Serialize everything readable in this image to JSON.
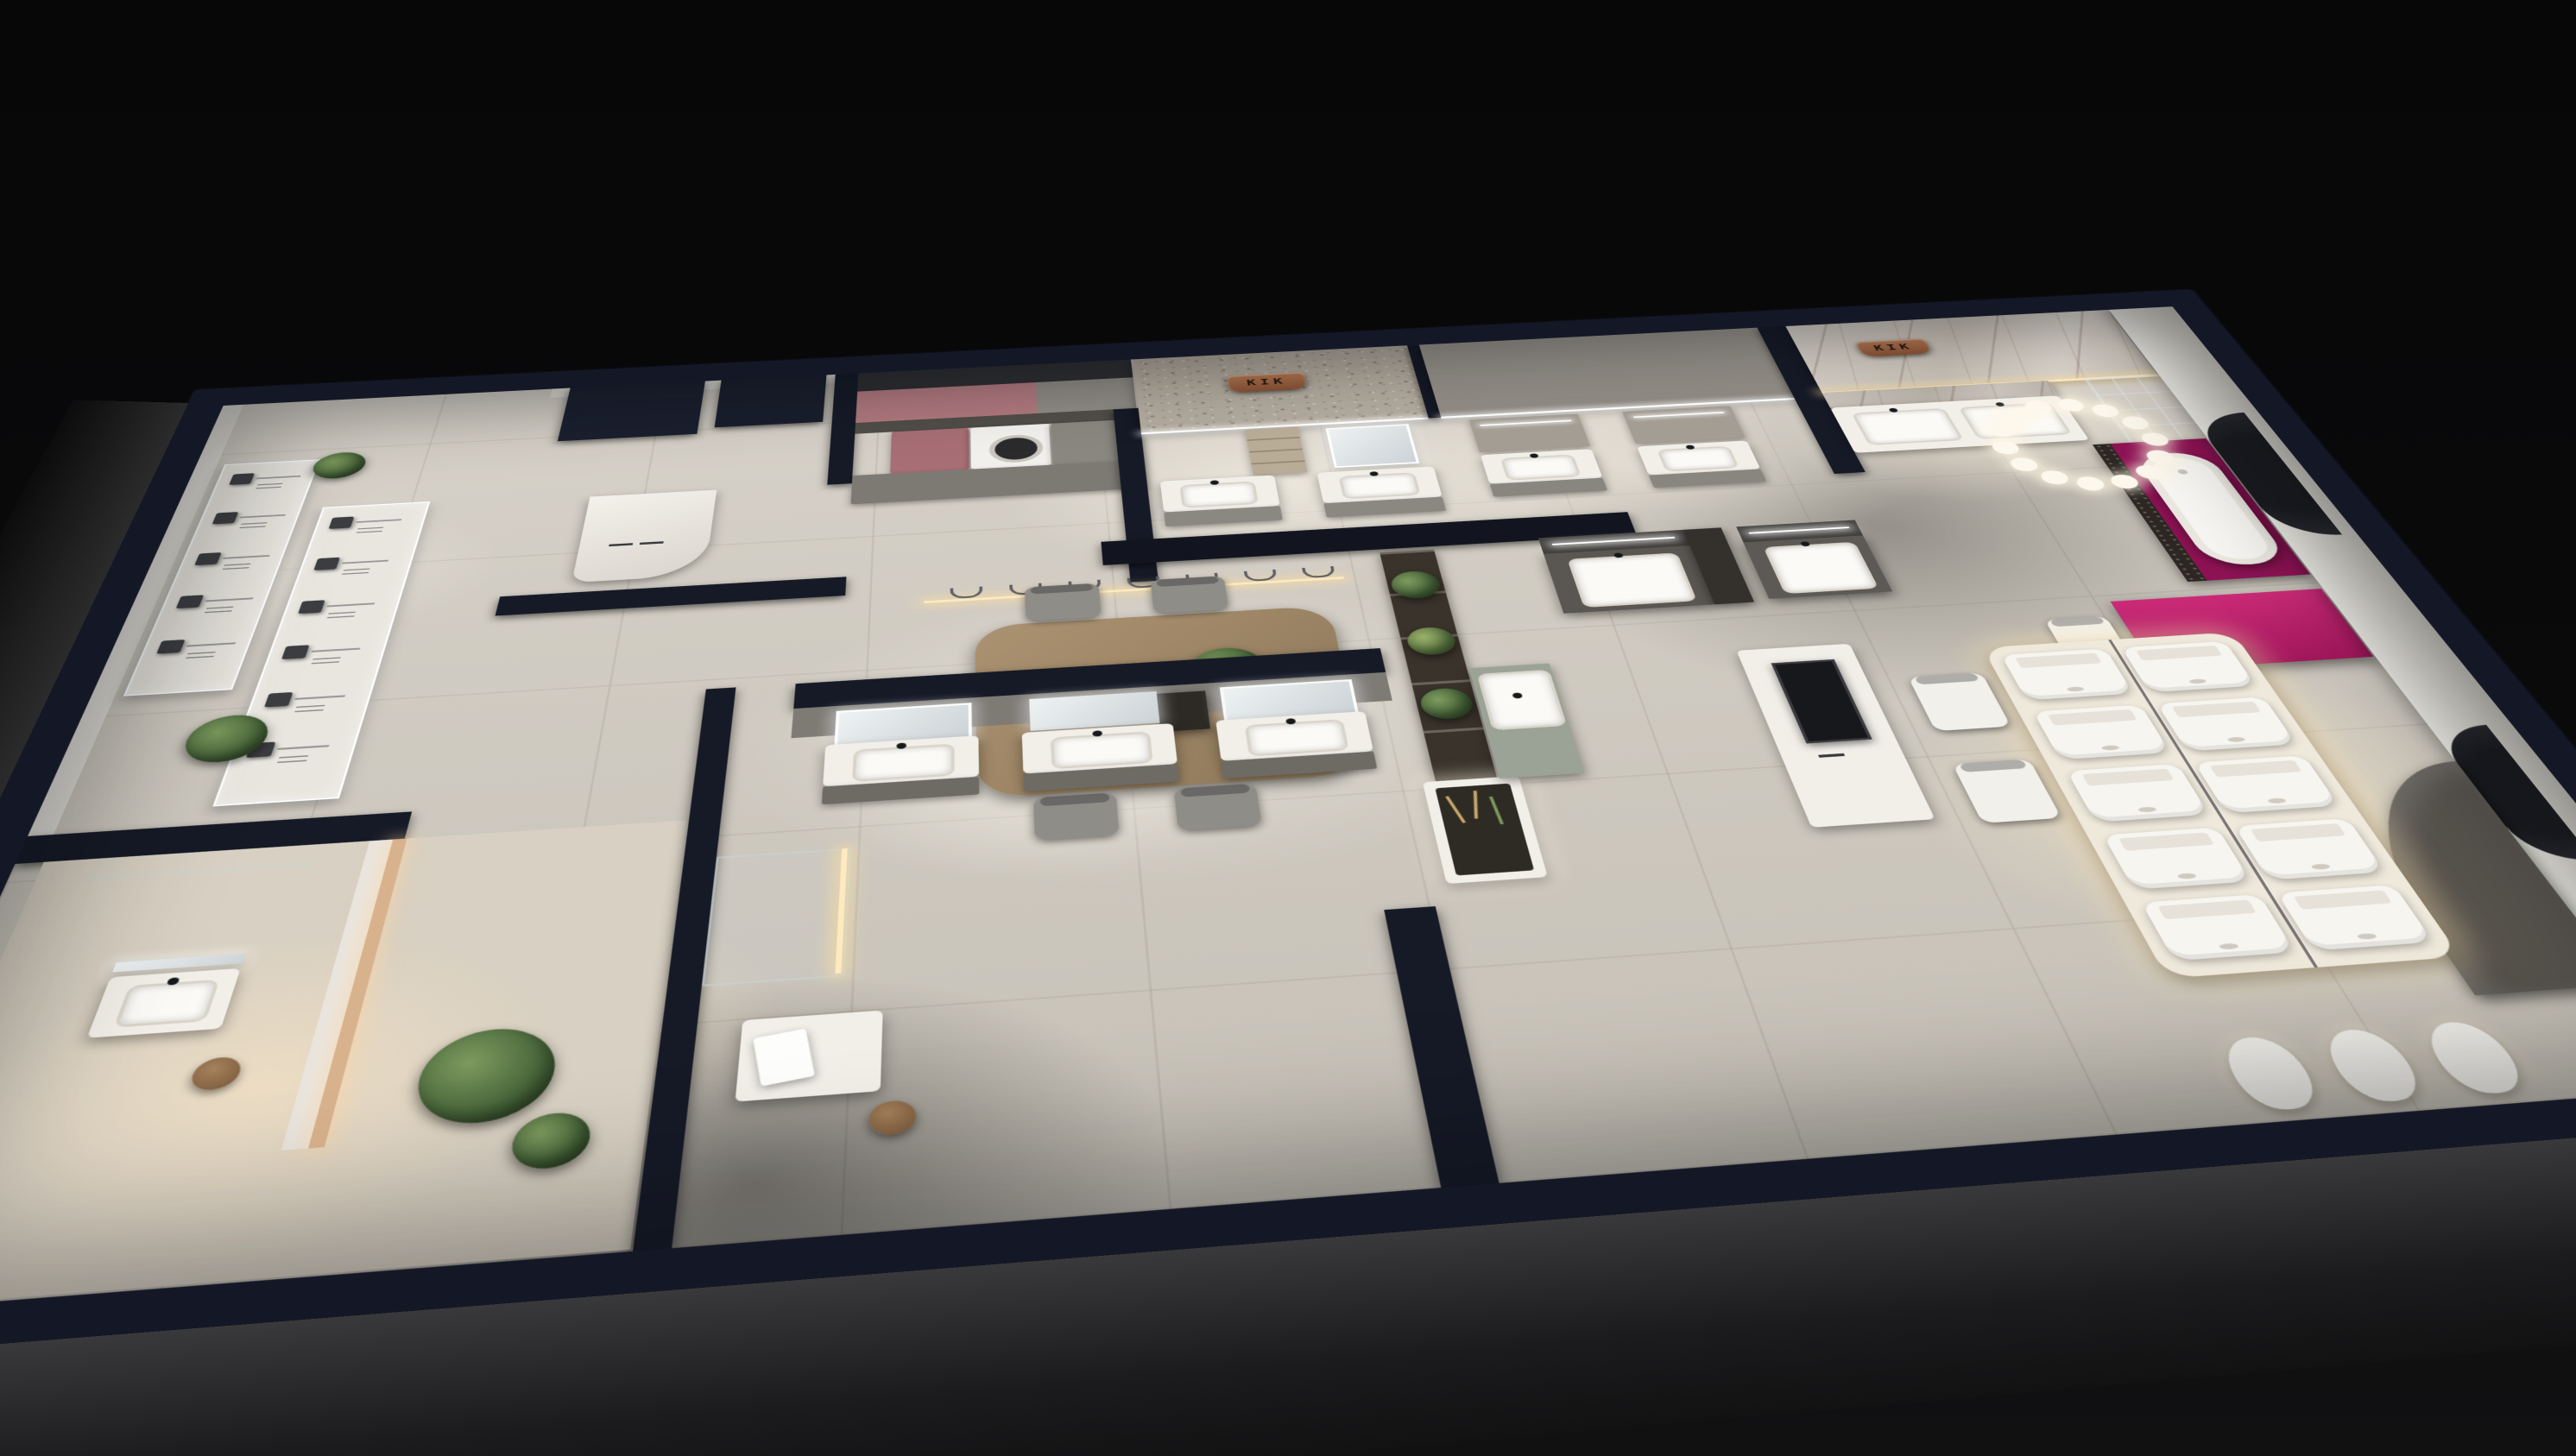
{
  "meta": {
    "title": "KIK sanitaryware showroom — night aerial dollhouse 3D render",
    "view": "top-down three-quarter perspective",
    "environment": "dark void background"
  },
  "brand": {
    "sign_text": "KIK",
    "sign_count": 2,
    "sign_color": "#a5663f"
  },
  "palette": {
    "background": "#060607",
    "outer_wall_navy": "#151926",
    "floor_light": "#d2cdc4",
    "magenta_platform": "#8e1355",
    "magenta_desk": "#b81a68",
    "stone_terrazzo": "#b2aa9e",
    "marble": "#d3ccc2",
    "wood_table": "#a18a69",
    "plant_green": "#47663a",
    "warm_led": "#ffe5ae"
  },
  "inventory": {
    "shower_panels": {
      "label": "shower fixture display panels",
      "count": 2,
      "heads_panel_1": 5,
      "heads_panel_2": 6
    },
    "north_vanities": {
      "label": "wall-hung vanity displays on north wall",
      "count": 4
    },
    "center_vanities": {
      "label": "dark vanity displays at center",
      "count": 2
    },
    "south_vanities": {
      "label": "vanity displays on south partition",
      "count": 3
    },
    "vip_double_vanity": {
      "label": "double-basin marble vanity",
      "basins": 2
    },
    "bathtub": {
      "label": "freestanding bathtub on magenta plinth",
      "count": 1
    },
    "chandelier_bubbles": 14,
    "pendant_hooks": 7,
    "toilets": {
      "label": "illuminated toilet display plinth",
      "count": 10,
      "columns": 2,
      "rows": 5
    },
    "urinals": {
      "count": 3
    },
    "washing_machine": {
      "count": 1
    },
    "meeting_chairs": 5,
    "guest_chairs_white": 3,
    "plants": 8,
    "service_desk": {
      "label": "curved reception desk"
    },
    "media_counter": {
      "label": "display counter with screen"
    },
    "green_wall": {
      "label": "vertical garden panel"
    },
    "arched_wall_openings": 2
  }
}
